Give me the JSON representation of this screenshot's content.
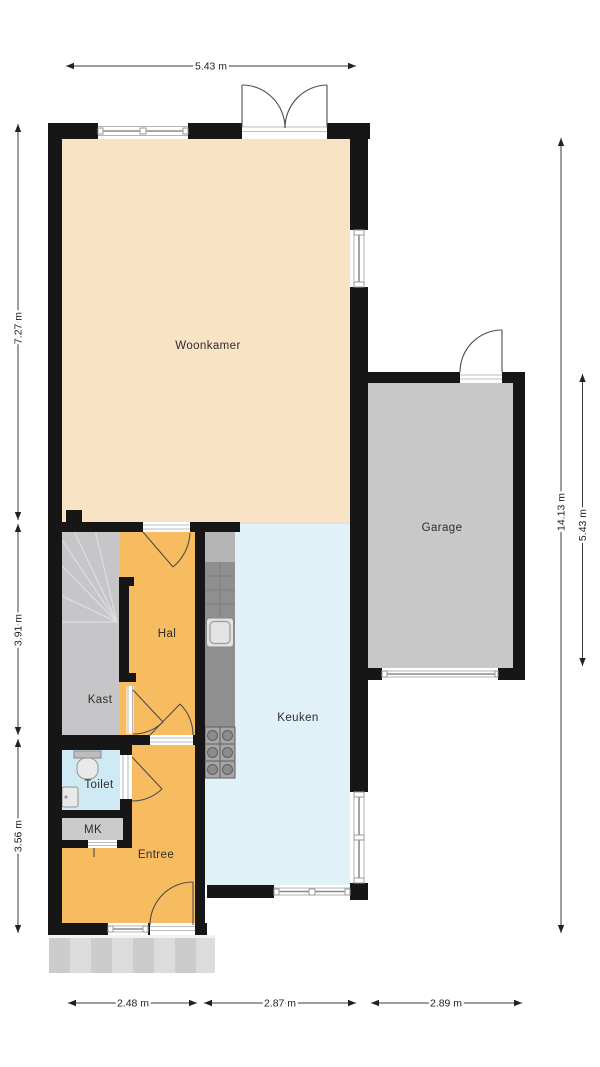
{
  "plan": {
    "colors": {
      "wall": "#161616",
      "woonkamer": "#f8e3c5",
      "hal": "#f7bb60",
      "entree": "#f7bb60",
      "keuken": "#e0f1f7",
      "toilet": "#cfe9f5",
      "kast": "#c6c6c8",
      "mk": "#cbcbcb",
      "garage": "#c8c8c8",
      "counter": "#8f8f8f",
      "counter_top": "#b5b5b5",
      "porch": "#d8d8d8",
      "window_white": "#ffffff"
    },
    "rooms": [
      {
        "label": "Woonkamer"
      },
      {
        "label": "Garage"
      },
      {
        "label": "Keuken"
      },
      {
        "label": "Hal"
      },
      {
        "label": "Kast"
      },
      {
        "label": "Toilet"
      },
      {
        "label": "MK"
      },
      {
        "label": "Entree"
      }
    ],
    "dims": {
      "top": {
        "label": "5.43 m"
      },
      "left": [
        {
          "label": "7.27 m"
        },
        {
          "label": "3.91 m"
        },
        {
          "label": "3.56 m"
        }
      ],
      "right": [
        {
          "label": "14.13 m"
        },
        {
          "label": "5.43 m"
        }
      ],
      "bottom": [
        {
          "label": "2.48 m"
        },
        {
          "label": "2.87 m"
        },
        {
          "label": "2.89 m"
        }
      ]
    },
    "icons": [
      "stairs-icon",
      "toilet-wc-icon",
      "hand-basin-icon",
      "kitchen-sink-icon",
      "stove-burners-icon"
    ]
  }
}
